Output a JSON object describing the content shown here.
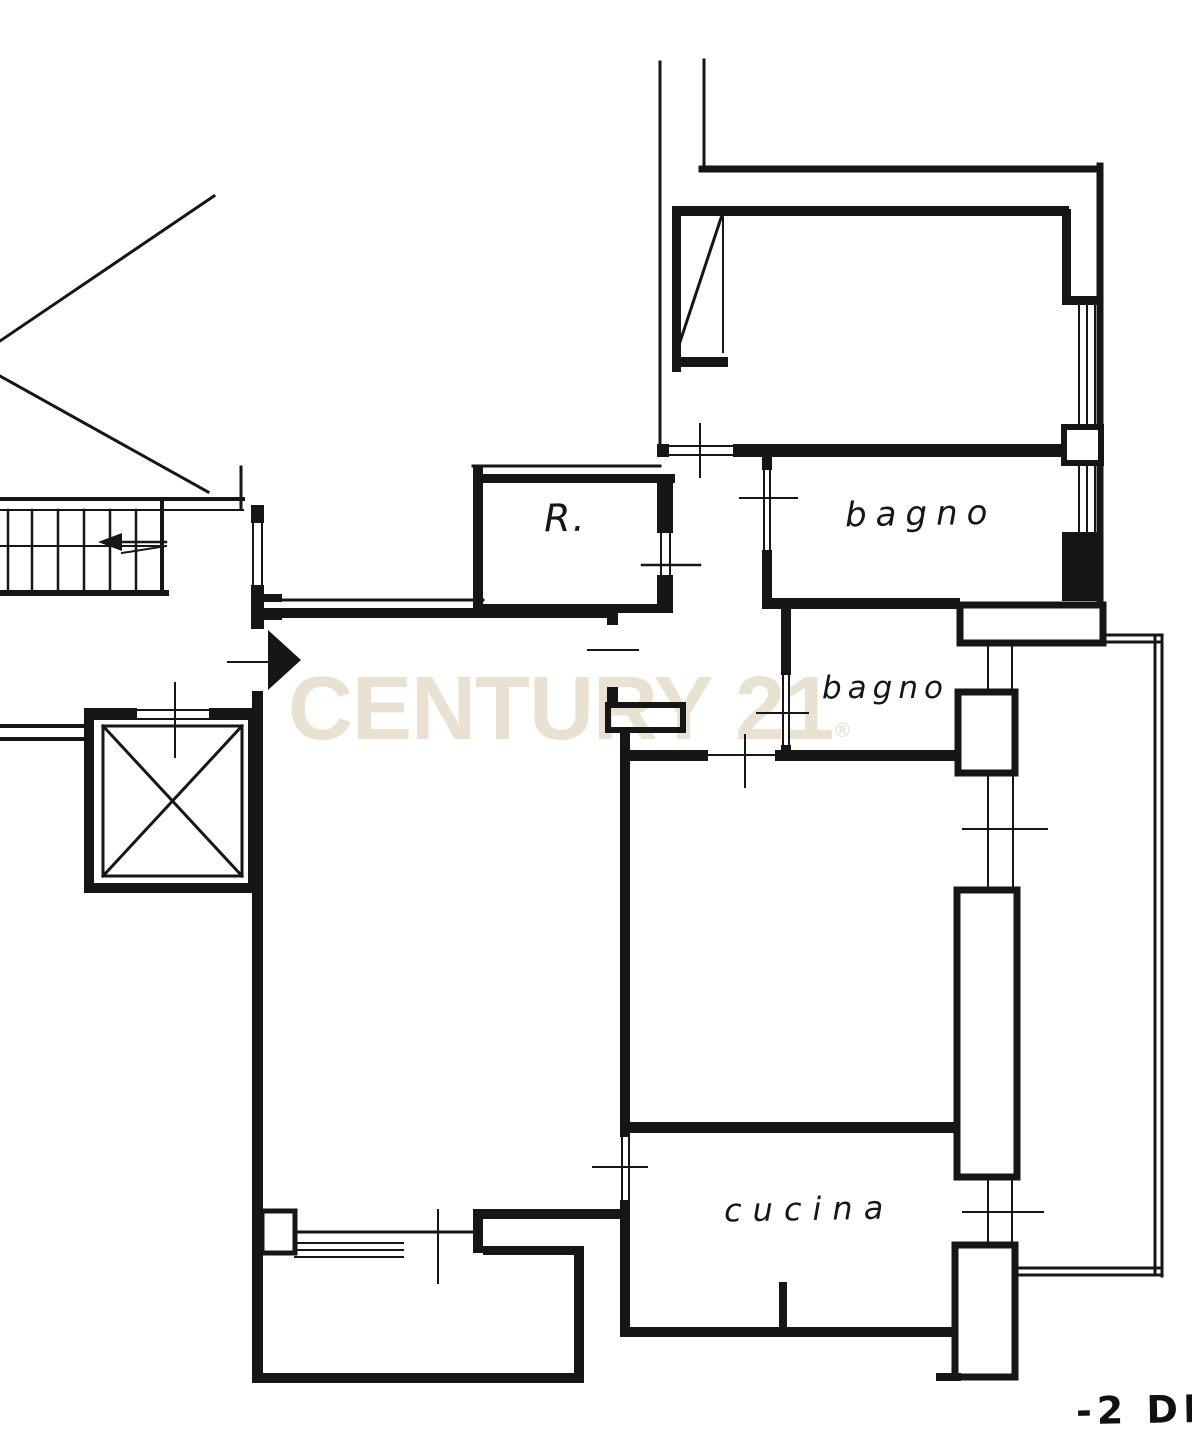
{
  "plan": {
    "labels": {
      "room_r": "R.",
      "bathroom_top": "bagno",
      "bathroom_mid": "bagno",
      "kitchen": "cucina"
    },
    "watermark": {
      "text": "CENTURY 21",
      "registered": "®",
      "color": "#e9e2d2"
    },
    "stamp": {
      "text": "-2 DI"
    },
    "icons": {
      "entrance_arrow": "right-filled-triangle",
      "stair_direction_arrow": "left-filled-triangle",
      "elevator_symbol": "crossed-box"
    },
    "colors": {
      "ink": "#161616",
      "background": "#ffffff"
    }
  }
}
